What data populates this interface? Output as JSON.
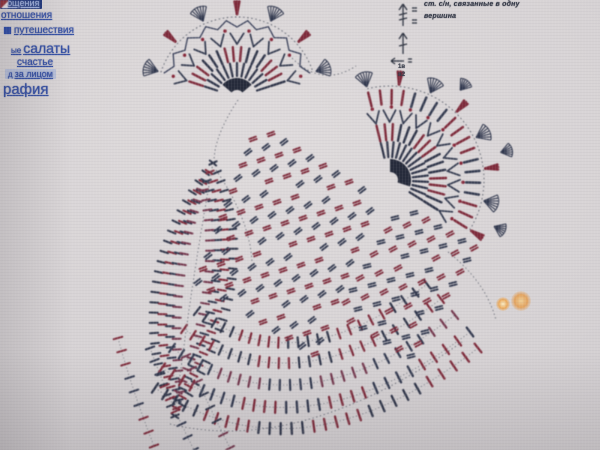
{
  "window": {
    "kind": "photo-of-screen",
    "content": "crochet pattern chart webpage"
  },
  "sidebar": {
    "links": [
      {
        "label": "общения",
        "x": 0,
        "y": -2,
        "size": 9,
        "variant": "hl-dark"
      },
      {
        "label": "отношения",
        "x": 1,
        "y": 10,
        "size": 10,
        "variant": ""
      },
      {
        "label": "путешествия",
        "x": 4,
        "y": 25,
        "size": 10,
        "variant": "",
        "icon": true
      },
      {
        "label": "салаты",
        "x": 11,
        "y": 40,
        "size": 14,
        "variant": "",
        "prefix": "ые"
      },
      {
        "label": "счастье",
        "x": 17,
        "y": 57,
        "size": 10,
        "variant": ""
      },
      {
        "label": "за лицом",
        "x": 5,
        "y": 69,
        "size": 9,
        "variant": "hl-light",
        "prefix": "д"
      },
      {
        "label": "рафия",
        "x": 3,
        "y": 81,
        "size": 15,
        "variant": ""
      }
    ]
  },
  "legend": {
    "line1": "ст. с/н, связанные в одну",
    "line2": "вершина",
    "small1": "1в",
    "small2": "в2"
  },
  "artifacts": {
    "glows": [
      {
        "x": 503,
        "y": 304,
        "r": 7,
        "core": "#f8ecc6",
        "mid": "#eaa95c"
      },
      {
        "x": 521,
        "y": 301,
        "r": 10,
        "core": "#f0cf96",
        "mid": "#e2a360"
      }
    ]
  },
  "diagram": {
    "palette": {
      "navy": "#30364a",
      "navy2": "#333a50",
      "red": "#7f2c3c",
      "plum": "#74384e",
      "ink": "#2e3340",
      "dot": "#5a5f6b"
    },
    "fans": [
      {
        "cx": 237,
        "cy": 97,
        "a0": -162,
        "a1": -18,
        "rows": [
          {
            "type": "wedge",
            "r0": 7,
            "r1": 19,
            "color": "#262b3b",
            "trim0": 22,
            "trim1": -22
          },
          {
            "type": "bars",
            "r0": 21,
            "r1": 34,
            "n": 13,
            "colors": [
              "#30364a"
            ],
            "w": 2.2
          },
          {
            "type": "bars",
            "r0": 36,
            "r1": 50,
            "n": 16,
            "colors": [
              "#7f2c3c",
              "#30364a"
            ],
            "block": 3,
            "w": 2.4
          },
          {
            "type": "vee",
            "r0": 53,
            "r1": 64,
            "n": 9,
            "color": "#343b50",
            "spread": 6,
            "w": 1.7
          },
          {
            "type": "dots",
            "r": 67,
            "n": 8,
            "color": "#87283a",
            "rad": 1.7
          },
          {
            "type": "zigzag",
            "r0": 70,
            "r1": 77,
            "n": 18,
            "color": "#39405a",
            "w": 1.3
          },
          {
            "type": "dotarc",
            "r": 80
          },
          {
            "type": "shells",
            "r0": 83,
            "len": 15,
            "n": 7,
            "pattern": [
              "fan",
              "redbars"
            ]
          }
        ]
      },
      {
        "cx": 390,
        "cy": 180,
        "a0": -104,
        "a1": 32,
        "rows": [
          {
            "type": "wedge",
            "r0": 8,
            "r1": 21,
            "color": "#262b3b",
            "trim0": 14,
            "trim1": -14
          },
          {
            "type": "bars",
            "r0": 23,
            "r1": 38,
            "n": 15,
            "colors": [
              "#30364a"
            ],
            "w": 2.2
          },
          {
            "type": "bars",
            "r0": 40,
            "r1": 56,
            "n": 17,
            "colors": [
              "#7f2c3c",
              "#30364a"
            ],
            "block": 3,
            "w": 2.4
          },
          {
            "type": "vee",
            "r0": 58,
            "r1": 70,
            "n": 11,
            "color": "#343b50",
            "spread": 5,
            "w": 1.7
          },
          {
            "type": "dots",
            "r": 73,
            "n": 10,
            "color": "#87283a",
            "rad": 1.7
          },
          {
            "type": "bars",
            "r0": 76,
            "r1": 90,
            "n": 19,
            "colors": [
              "#7f2c3c",
              "#343b50"
            ],
            "block": 4,
            "w": 2.5
          },
          {
            "type": "dotarc",
            "r": 94
          },
          {
            "type": "shells",
            "r0": 96,
            "len": 15,
            "n": 8,
            "pattern": [
              "fan",
              "redbars"
            ]
          },
          {
            "type": "shells",
            "r0": 114,
            "len": 12,
            "n": 3,
            "pattern": [
              "fan"
            ],
            "aAbs": [
              -52,
              24
            ]
          }
        ]
      }
    ],
    "tickpaths": [
      {
        "path": [
          213,
          163,
          118,
          285,
          175,
          416
        ],
        "n": 26,
        "len": 8,
        "colors": [
          "#30364a"
        ],
        "w": 2
      },
      {
        "path": [
          209,
          172,
          136,
          287,
          177,
          408
        ],
        "n": 24,
        "len": 8,
        "colors": [
          "#7f2c3c"
        ],
        "w": 2
      },
      {
        "path": [
          205,
          181,
          152,
          289,
          179,
          400
        ],
        "n": 22,
        "len": 8,
        "colors": [
          "#333a50"
        ],
        "w": 2
      },
      {
        "path": [
          201,
          190,
          166,
          291,
          181,
          392
        ],
        "n": 20,
        "len": 8,
        "colors": [
          "#74384e"
        ],
        "w": 2
      },
      {
        "path": [
          213,
          163,
          268,
          278,
          175,
          416
        ],
        "n": 26,
        "len": 8,
        "colors": [
          "#30364a"
        ],
        "w": 2
      },
      {
        "path": [
          210,
          172,
          252,
          280,
          176,
          408
        ],
        "n": 24,
        "len": 8,
        "colors": [
          "#7f2c3c"
        ],
        "w": 2
      },
      {
        "path": [
          207,
          181,
          238,
          282,
          177,
          400
        ],
        "n": 22,
        "len": 8,
        "colors": [
          "#333a50"
        ],
        "w": 2
      },
      {
        "path": [
          204,
          190,
          224,
          284,
          178,
          392
        ],
        "n": 20,
        "len": 8,
        "colors": [
          "#74384e"
        ],
        "w": 2
      },
      {
        "path": [
          155,
          388,
          300,
          486,
          478,
          348
        ],
        "n": 30,
        "len": 11,
        "colors": [
          "#30364a",
          "#7f2c3c"
        ],
        "block": 5,
        "w": 2.3,
        "spine": true
      },
      {
        "path": [
          162,
          368,
          300,
          462,
          470,
          332
        ],
        "n": 29,
        "len": 11,
        "colors": [
          "#7f2c3c",
          "#333a50"
        ],
        "block": 4,
        "w": 2.3,
        "spine": true
      },
      {
        "path": [
          172,
          348,
          298,
          436,
          455,
          315
        ],
        "n": 28,
        "len": 10,
        "colors": [
          "#333a50",
          "#74384e"
        ],
        "block": 5,
        "w": 2.2,
        "spine": true
      },
      {
        "path": [
          184,
          329,
          296,
          410,
          441,
          299
        ],
        "n": 26,
        "len": 10,
        "colors": [
          "#7f2c3c",
          "#30364a"
        ],
        "block": 4,
        "w": 2.2,
        "spine": true
      },
      {
        "path": [
          197,
          311,
          294,
          386,
          427,
          284
        ],
        "n": 24,
        "len": 10,
        "colors": [
          "#30364a",
          "#7f2c3c"
        ],
        "block": 5,
        "w": 2.2,
        "spine": true
      },
      {
        "path": [
          118,
          338,
          132,
          390,
          154,
          446
        ],
        "n": 9,
        "len": 9,
        "colors": [
          "#7f2c3c",
          "#333a50"
        ],
        "block": 3,
        "w": 2,
        "spine": true
      },
      {
        "path": [
          150,
          348,
          168,
          398,
          194,
          450
        ],
        "n": 9,
        "len": 9,
        "colors": [
          "#333a50",
          "#7f2c3c"
        ],
        "block": 3,
        "w": 2,
        "spine": true
      },
      {
        "path": [
          186,
          356,
          206,
          400,
          230,
          448
        ],
        "n": 8,
        "len": 9,
        "colors": [
          "#74384e",
          "#30364a"
        ],
        "block": 3,
        "w": 2,
        "spine": true
      }
    ],
    "lattices": [
      {
        "x": 258,
        "y": 126,
        "u": [
          13,
          8
        ],
        "nu": 10,
        "v": [
          -5,
          13
        ],
        "nv": 13,
        "len": 7,
        "bars": 2,
        "gap": 2.6,
        "angle": -38,
        "angleAlt": 18,
        "colors": [
          "#333a50",
          "#7f2c3c"
        ],
        "w": 1.8
      },
      {
        "x": 402,
        "y": 206,
        "u": [
          12,
          7
        ],
        "nu": 7,
        "v": [
          -7,
          12
        ],
        "nv": 10,
        "len": 7,
        "bars": 2,
        "gap": 2.6,
        "angle": -28,
        "angleAlt": 14,
        "colors": [
          "#7f2c3c",
          "#333a50"
        ],
        "w": 1.8
      }
    ],
    "dotarcs": [
      [
        292,
        58,
        322,
        88,
        356,
        66
      ],
      [
        213,
        163,
        190,
        290,
        175,
        416
      ],
      [
        238,
        100,
        214,
        136,
        214,
        162
      ],
      [
        216,
        170,
        250,
        220,
        252,
        262
      ],
      [
        448,
        252,
        486,
        282,
        496,
        320
      ],
      [
        170,
        424,
        300,
        456,
        462,
        342
      ]
    ],
    "legendSymbols": {
      "ink": "#2e3340"
    }
  }
}
